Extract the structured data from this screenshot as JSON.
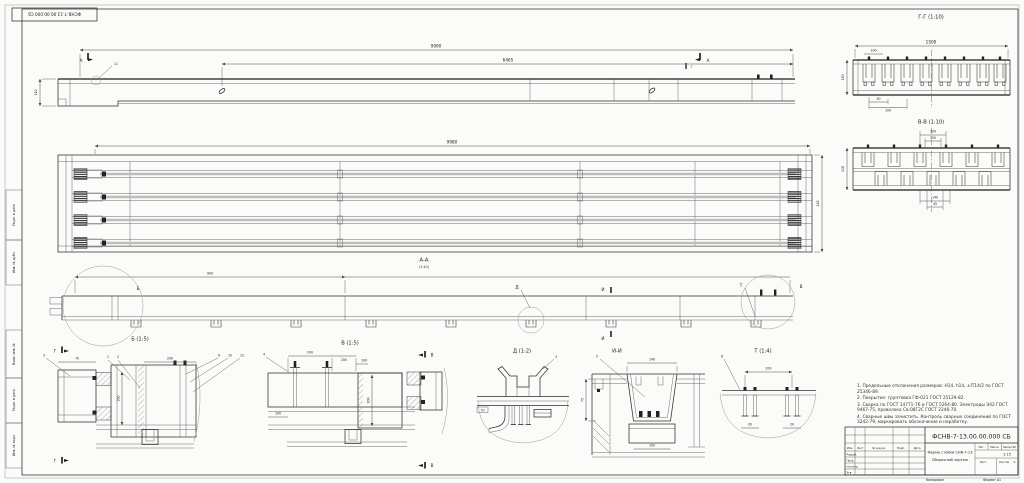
{
  "doc": {
    "number": "ФСНВ-7-13.00.00.000 СБ",
    "name_line1": "Ферма стойки СНВ-7-13",
    "name_line2": "Сборочный чертеж"
  },
  "stamp_top_left": "ФСНВ-7-13.00.00.000 СБ",
  "view_titles": {
    "aa": "А-А",
    "aa_scale": "(1:10)",
    "gg": "Г-Г (1:10)",
    "vv": "В-В (1:10)",
    "b": "Б (1:5)",
    "v": "В (1:5)",
    "d": "Д (1:2)",
    "ii": "И-И",
    "t": "Т (1:4)"
  },
  "dims": {
    "top_total": "9990",
    "top_partial": "6465",
    "top_height": "110",
    "plan_total": "9980",
    "plan_height": "118",
    "aa_partial": "900",
    "gg_total": "1500",
    "gg_top": "100",
    "gg_bot1": "50",
    "gg_bot2": "100",
    "gg_height": "150",
    "vv_top1": "300",
    "vv_top2": "100",
    "vv_bot1": "140",
    "vv_bot2": "45",
    "vv_height": "118",
    "b_left": "70",
    "b_right": "200",
    "b_vert": "300",
    "v_d1": "200",
    "v_d2": "200",
    "v_d3": "100",
    "v_vert": "300",
    "v_bot": "100",
    "d_tag": "70",
    "ii_top": "140",
    "ii_left": "75",
    "ii_bot": "100",
    "t_top": "200",
    "t_bot1": "20",
    "t_bot2": "20"
  },
  "callouts": {
    "a_left": "А",
    "a_right": "А",
    "g_mark": "Г",
    "weld_pos": "11",
    "b_circle": "Б",
    "v_circle": "В",
    "d_leader": "Д",
    "i_top": "И",
    "i_bot": "И",
    "t_leader": "Т",
    "sec_g_top": "Г",
    "sec_g_bot": "Г",
    "sec_v_top": "В",
    "sec_v_bot": "В",
    "pos1": "1",
    "pos2": "2",
    "pos3": "3",
    "pos4": "4",
    "pos5": "5",
    "pos6": "6",
    "pos9": "9",
    "pos10": "10",
    "pos12": "12",
    "d_pos": "3"
  },
  "tech_requirements": {
    "lines": [
      "1. Предельные отклонения размеров: Н14, h14, ±IT14/2 по ГОСТ 25346-89.",
      "2. Покрытие: грунтовка ГФ-021 ГОСТ 25129-82.",
      "3. Сварка по ГОСТ 14771-76 и ГОСТ 5264-80. Электроды Э42 ГОСТ 9467-75, проволока Св-08Г2С ГОСТ 2246-70.",
      "4. Сварные швы зачистить. Контроль сварных соединений по ГОСТ 3242-79, маркировать обозначение и наработку."
    ]
  },
  "title_block": {
    "change_header": [
      "Изм.",
      "Лист",
      "№ докум.",
      "Подп.",
      "Дата"
    ],
    "sig_rows": [
      "Разраб.",
      "Пров.",
      "Н.контр.",
      "Утв."
    ],
    "lit_label": "Лит.",
    "mass_label": "Масса",
    "scale_label": "Масштаб",
    "scale_value": "1:15",
    "sheet_label": "Лист",
    "sheets_label": "Листов",
    "sheets_value": "6",
    "kopiroval": "Копировал",
    "format": "Формат А1"
  },
  "margin_labels": [
    "Подп. и дата",
    "Инв. № дубл.",
    "Взам. инв. №",
    "Подп. и дата",
    "Инв. № подл."
  ]
}
